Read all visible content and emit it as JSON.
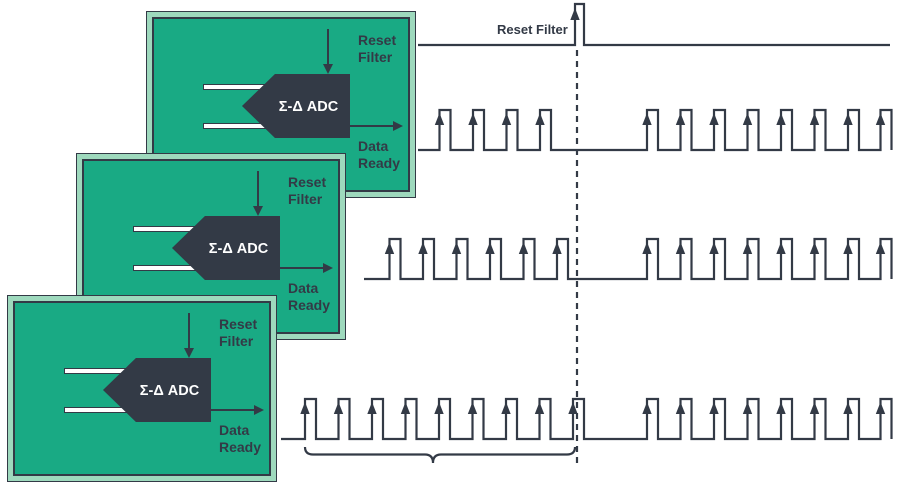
{
  "colors": {
    "green": "#19aa84",
    "mint": "#9ed9bd",
    "dark": "#333a46",
    "white": "#ffffff"
  },
  "cards": [
    {
      "x": 146,
      "y": 11,
      "z": 1,
      "reset_line1": "Reset",
      "reset_line2": "Filter",
      "adc_label": "Σ-Δ ADC",
      "data_line1": "Data",
      "data_line2": "Ready"
    },
    {
      "x": 76,
      "y": 153,
      "z": 2,
      "reset_line1": "Reset",
      "reset_line2": "Filter",
      "adc_label": "Σ-Δ ADC",
      "data_line1": "Data",
      "data_line2": "Ready"
    },
    {
      "x": 7,
      "y": 295,
      "z": 3,
      "reset_line1": "Reset",
      "reset_line2": "Filter",
      "adc_label": "Σ-Δ ADC",
      "data_line1": "Data",
      "data_line2": "Ready"
    }
  ],
  "timing": {
    "reset_label": "Reset Filter",
    "reset_trace": {
      "y": 45,
      "x0": 418,
      "x1": 890,
      "pulse_x": 575,
      "pulse_w": 9,
      "pulse_h": 41
    },
    "pulse_w": 11,
    "pulse_h": 40,
    "post_pulses": [
      647,
      680.5,
      714,
      747.5,
      781,
      814.5,
      848,
      880.5
    ],
    "data_traces": [
      {
        "y": 150,
        "x0": 418,
        "x1": 891.5,
        "pre": [
          439.5,
          473,
          506.5,
          540
        ]
      },
      {
        "y": 279,
        "x0": 364,
        "x1": 891.5,
        "pre": [
          389.5,
          423,
          456.5,
          490,
          523.5,
          557
        ]
      },
      {
        "y": 439,
        "x0": 281,
        "x1": 891.5,
        "pre": [
          305,
          338.5,
          372,
          405.5,
          439,
          472.5,
          506,
          539.5,
          573
        ]
      }
    ],
    "dashed_line": {
      "x": 577,
      "y0": 50,
      "y1": 467
    },
    "brace": {
      "x0": 305,
      "xmid": 433,
      "x1": 575,
      "ytop": 447,
      "ymid": 454.5,
      "ybot": 463
    }
  }
}
